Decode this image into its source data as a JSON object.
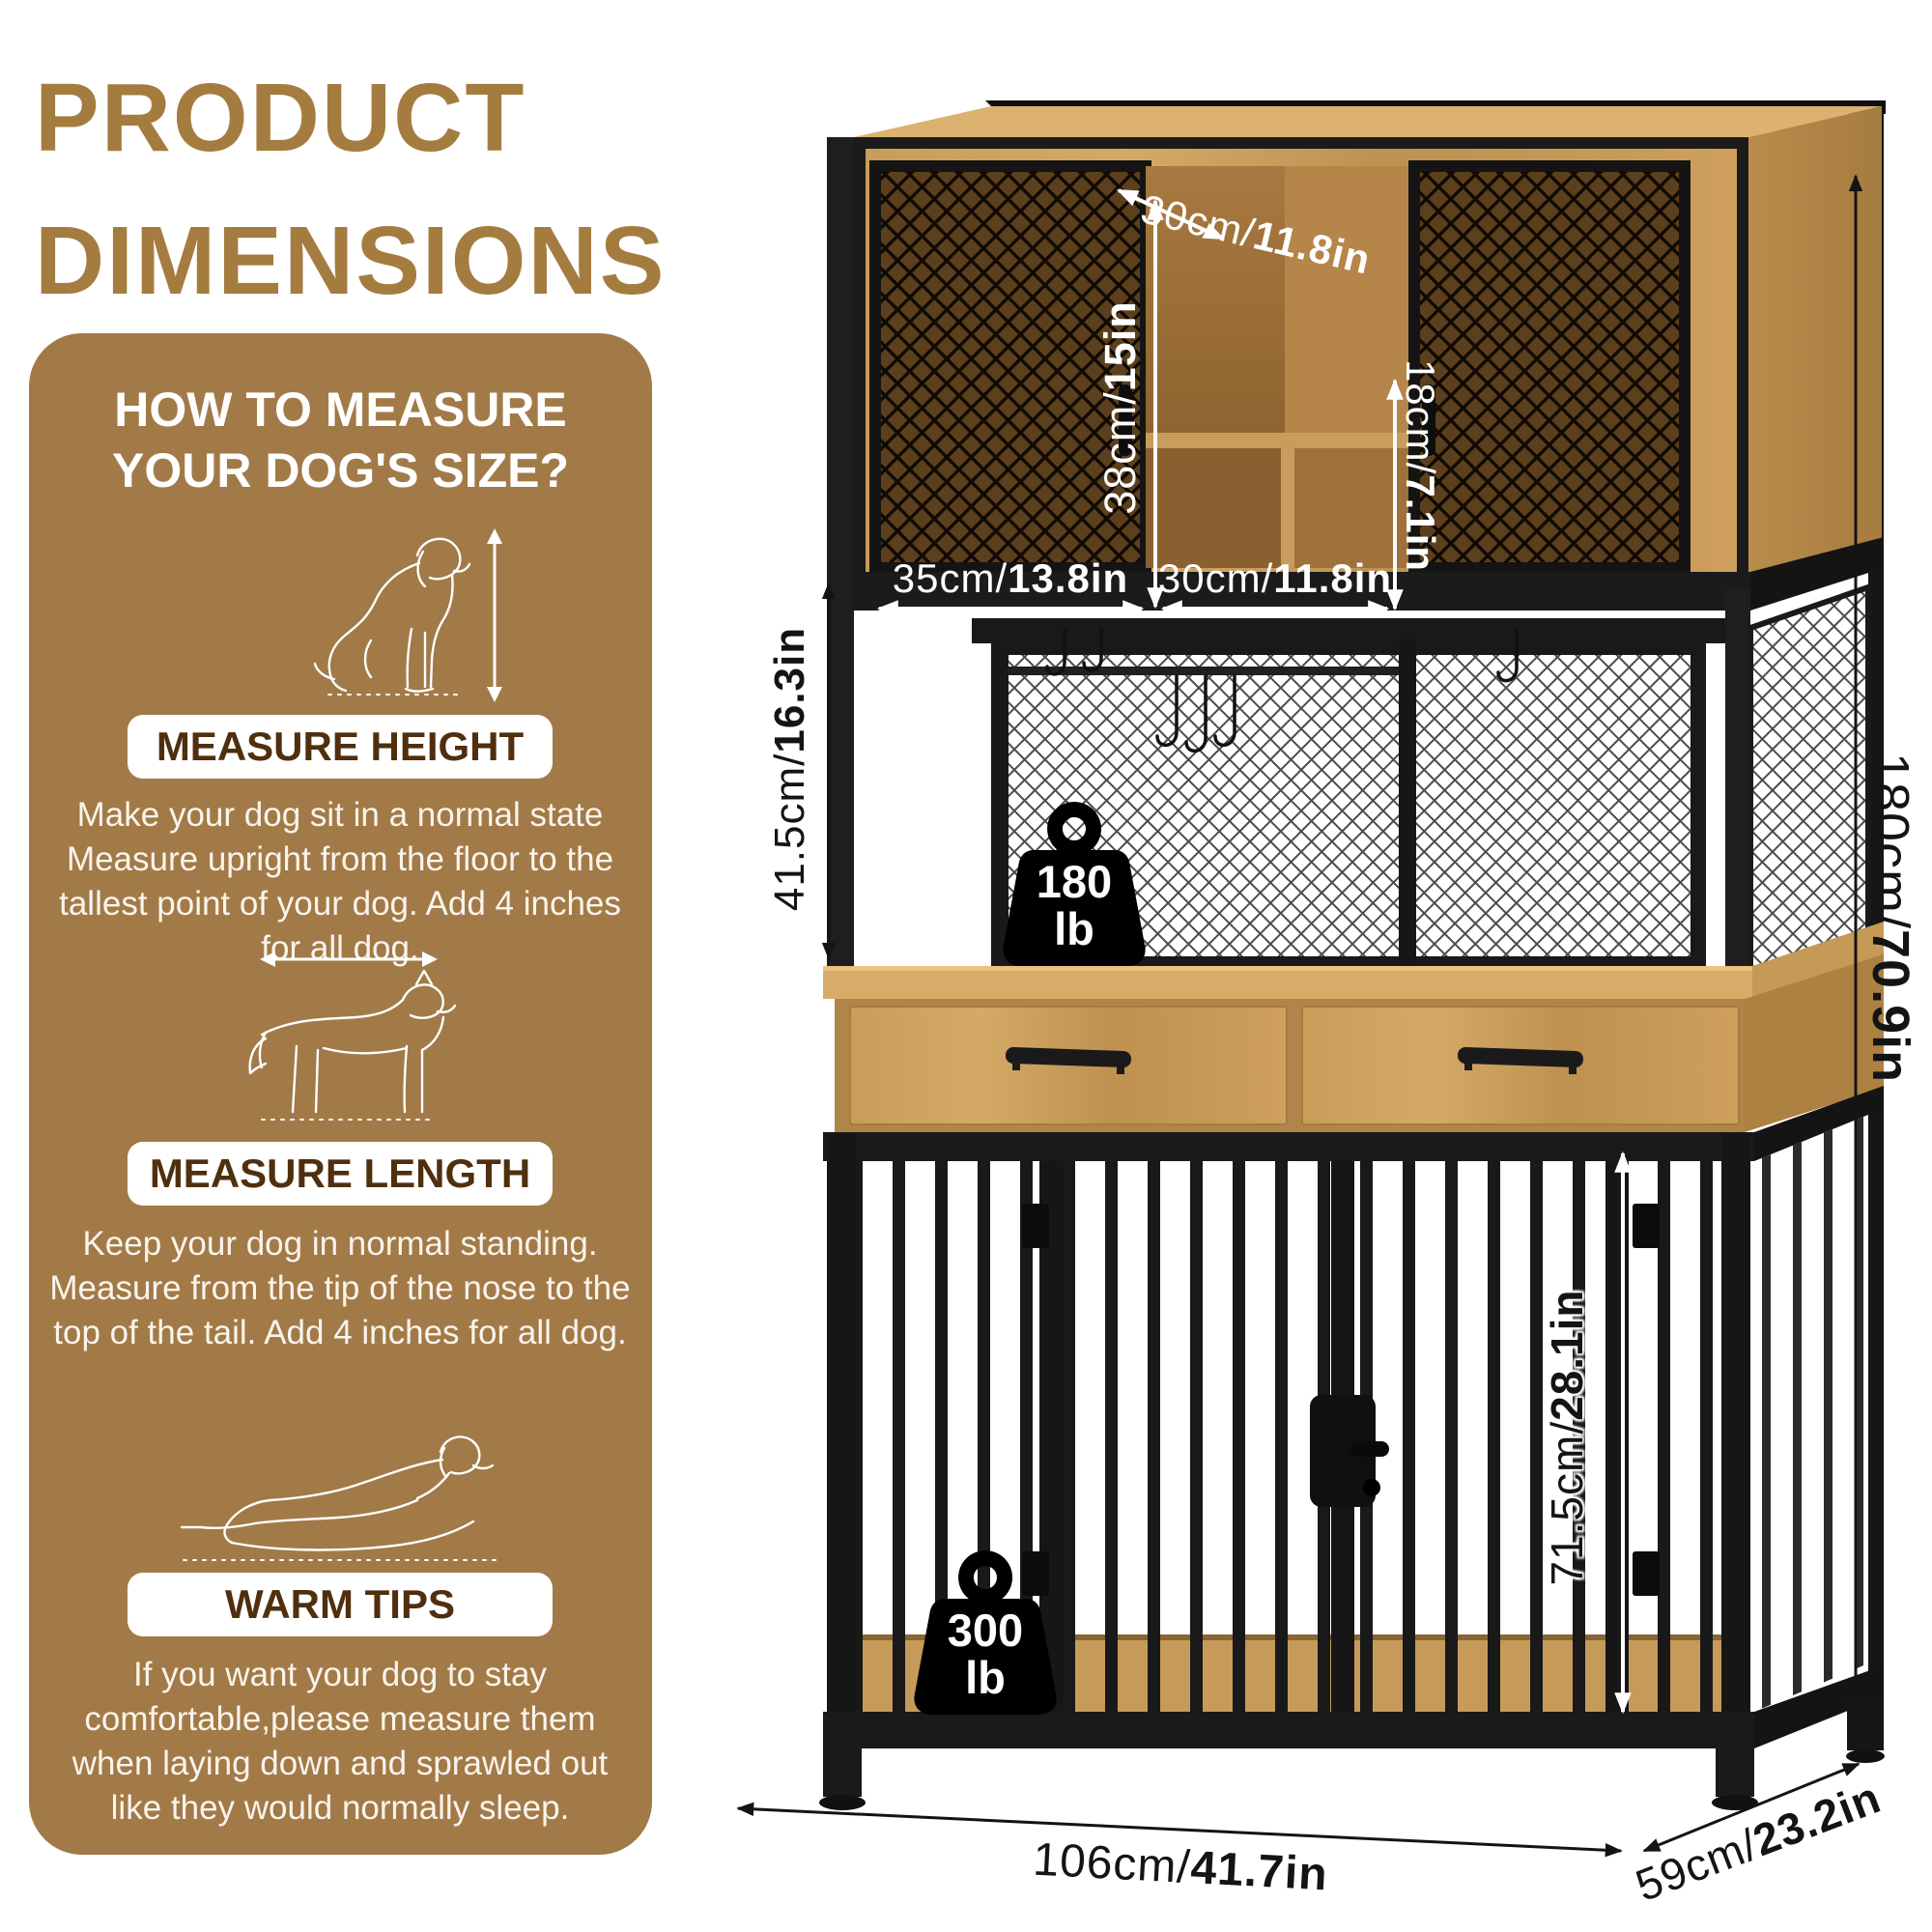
{
  "title": {
    "line1": "PRODUCT",
    "line2": "DIMENSIONS"
  },
  "panel": {
    "heading_line1": "HOW TO MEASURE",
    "heading_line2": "YOUR DOG'S SIZE?",
    "sections": [
      {
        "pill": "MEASURE HEIGHT",
        "text": "Make your dog sit in a normal state Measure upright from the floor to the tallest point of your dog. Add 4 inches for all dog."
      },
      {
        "pill": "MEASURE LENGTH",
        "text": "Keep your dog in normal standing. Measure from the tip of the nose to the top of the tail. Add 4 inches for all dog."
      },
      {
        "pill": "WARM TIPS",
        "text": "If you want your dog to stay comfortable,please measure them when laying down and sprawled out like they would normally sleep."
      }
    ]
  },
  "dimensions": {
    "top_depth": {
      "cm": "30cm/",
      "in": "11.8in"
    },
    "left_door_height": {
      "cm": "38cm/",
      "in": "15in"
    },
    "right_cubby_height": {
      "cm": "18cm/",
      "in": "7.1in"
    },
    "left_door_width": {
      "cm": "35cm/",
      "in": "13.8in"
    },
    "center_cubby_width": {
      "cm": "30cm/",
      "in": "11.8in"
    },
    "hutch_opening_height": {
      "cm": "41.5cm/",
      "in": "16.3in"
    },
    "total_height": {
      "cm": "180cm/",
      "in": "70.9in"
    },
    "crate_height": {
      "cm": "71.5cm/",
      "in": "28.1in"
    },
    "total_width": {
      "cm": "106cm/",
      "in": "41.7in"
    },
    "depth": {
      "cm": "59cm/",
      "in": "23.2in"
    }
  },
  "capacity": {
    "hutch": {
      "value": "180",
      "unit": "lb"
    },
    "crate": {
      "value": "300",
      "unit": "lb"
    }
  },
  "colors": {
    "brand_brown": "#A57C3F",
    "panel_brown": "#A27A48",
    "pill_text": "#4F2F0E",
    "wood": "#C89C5A",
    "metal": "#1B1B1B"
  }
}
